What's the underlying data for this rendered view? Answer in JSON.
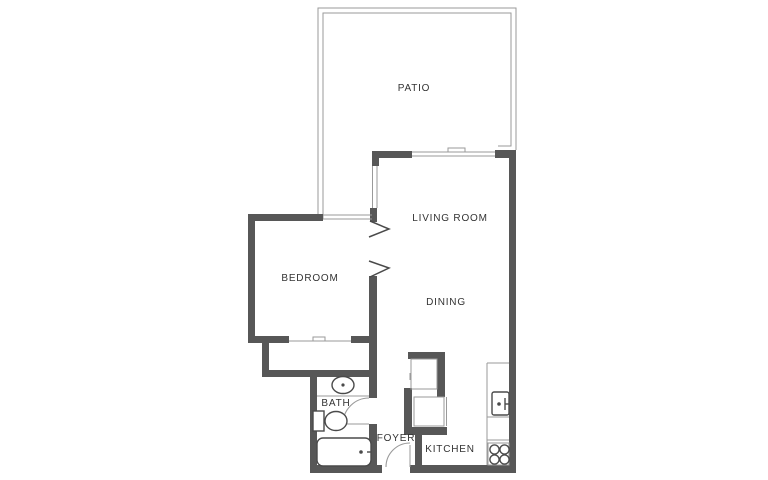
{
  "title": "One-bedroom apartment floor plan",
  "colors": {
    "background": "#ffffff",
    "wall": "#575757",
    "thin_line": "#9a9a9a",
    "fixture_line": "#4a4a4a",
    "label_text": "#333333"
  },
  "rooms": [
    {
      "id": "patio",
      "label": "PATIO"
    },
    {
      "id": "living-room",
      "label": "LIVING ROOM"
    },
    {
      "id": "bedroom",
      "label": "BEDROOM"
    },
    {
      "id": "dining",
      "label": "DINING"
    },
    {
      "id": "bath",
      "label": "BATH"
    },
    {
      "id": "foyer",
      "label": "FOYER"
    },
    {
      "id": "kitchen",
      "label": "KITCHEN"
    }
  ],
  "fixtures": [
    "bath-sink",
    "toilet",
    "bathtub",
    "kitchen-sink",
    "stove",
    "kitchen-counter",
    "bedroom-closet",
    "utility-closets"
  ],
  "openings": [
    "patio-sliding-door",
    "living-room-side-window",
    "bedroom-patio-window",
    "bedroom-door",
    "bedroom-closet-doors",
    "bath-door",
    "entry-door"
  ]
}
